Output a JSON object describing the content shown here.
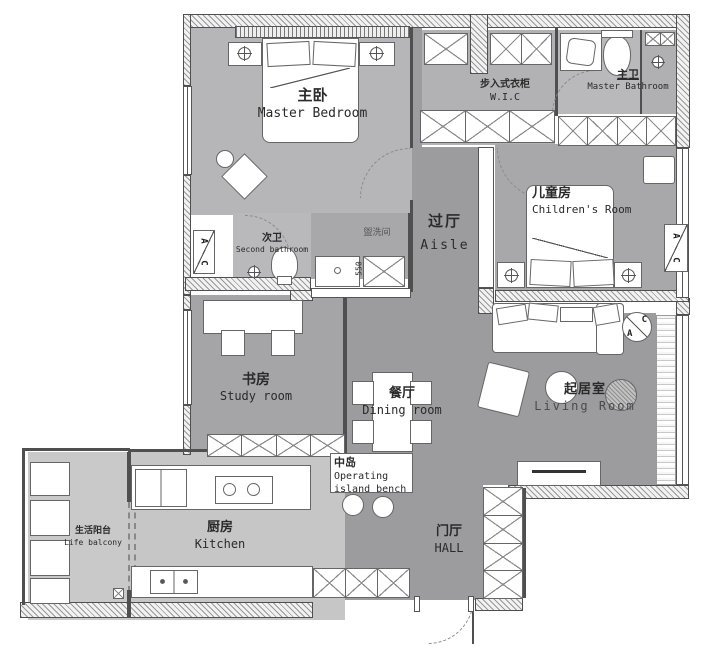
{
  "rooms": {
    "master_bedroom": {
      "zh": "主卧",
      "en": "Master Bedroom"
    },
    "wic": {
      "zh": "步入式衣柜",
      "en": "W.I.C"
    },
    "master_bathroom": {
      "zh": "主卫",
      "en": "Master Bathroom"
    },
    "childrens_room": {
      "zh": "儿童房",
      "en": "Children's Room"
    },
    "aisle": {
      "zh": "过厅",
      "en": "Aisle"
    },
    "second_bathroom": {
      "zh": "次卫",
      "en": "Second bathroom"
    },
    "washroom": {
      "zh": "盥洗间",
      "en": ""
    },
    "study_room": {
      "zh": "书房",
      "en": "Study room"
    },
    "dining_room": {
      "zh": "餐厅",
      "en": "Dining room"
    },
    "island": {
      "zh": "中岛",
      "en_line1": "Operating",
      "en_line2": "island bench"
    },
    "living_room": {
      "zh": "起居室",
      "en": "Living Room"
    },
    "kitchen": {
      "zh": "厨房",
      "en": "Kitchen"
    },
    "life_balcony": {
      "zh": "生活阳台",
      "en": "Life balcony"
    },
    "hall": {
      "zh": "门厅",
      "en": "HALL"
    }
  },
  "annotations": {
    "dim_550": "550",
    "ac_a": "A",
    "ac_c": "C"
  },
  "colors": {
    "floor_light": "#b6b6b8",
    "floor_mid": "#a7a7a9",
    "floor_dark": "#9c9c9e",
    "floor_kitchen": "#c6c6c7",
    "wall_line": "#4f4f4f",
    "background": "#ffffff"
  }
}
